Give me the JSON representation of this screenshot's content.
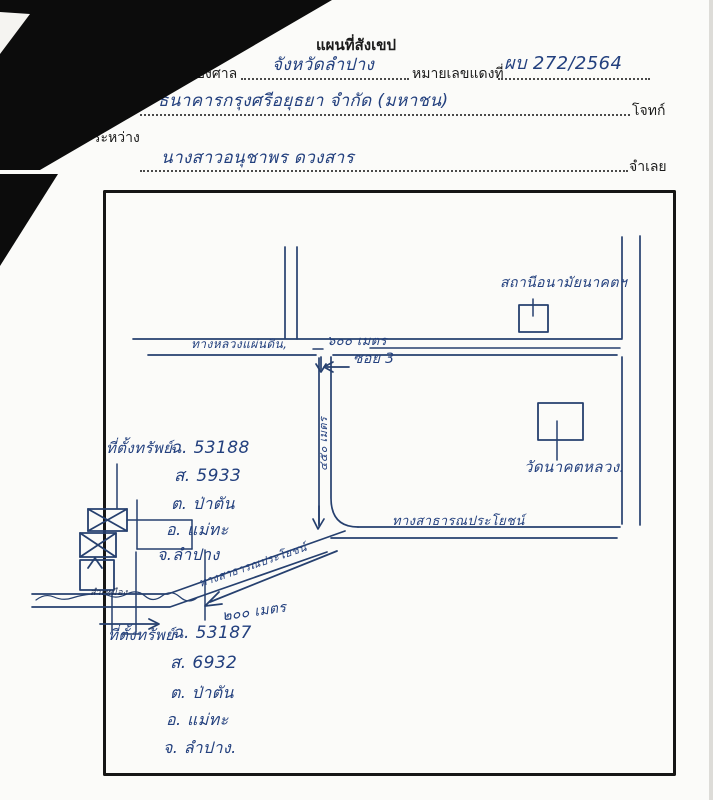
{
  "header": {
    "title": "แผนที่สังเขป",
    "case_label": "คดี",
    "case_type_value": "แพ่ง",
    "court_label": "ของศาล",
    "court_name_value": "จังหวัดลำปาง",
    "red_case_label": "หมายเลขแดงที่",
    "red_case_value": "ผบ 272/2564",
    "plaintiff_name_value": "ธนาคารกรุงศรีอยุธยา จำกัด (มหาชน)",
    "plaintiff_label": "โจทก์",
    "between_label": "ระหว่าง",
    "defendant_name_value": "นางสาวอนุชาพร ดวงสาร",
    "defendant_label": "จำเลย"
  },
  "map": {
    "roads": {
      "highway": "ทางหลวงแผ่นดิน,",
      "soi": "ซอย 3",
      "public_road": "ทางสาธารณประโยชน์",
      "public_road_diagonal": "ทางสาธารณประโยชน์",
      "canal": "ลำเหมือง"
    },
    "distances": {
      "d600": "๖๐๐ เมตร",
      "d450": "๔๕๐ เมตร",
      "d200": "๒๐๐ เมตร"
    },
    "places": {
      "health_station": "สถานีอนามัยนาคตฯ",
      "temple": "วัดนาคตหลวง."
    },
    "property1": {
      "title": "ที่ตั้งทรัพย์",
      "lines": [
        "ฉ. 53188",
        "ส. 5933",
        "ต. ป่าตัน",
        "อ. แม่ทะ",
        "จ.ลำปาง"
      ]
    },
    "property2": {
      "title": "ที่ตั้งทรัพย์",
      "lines": [
        "ฉ. 53187",
        "ส. 6932",
        "ต. ป่าตัน",
        "อ. แม่ทะ",
        "จ. ลำปาง."
      ]
    }
  },
  "colors": {
    "ink_blue": "#26406f",
    "printed_black": "#1b1b1b",
    "border_black": "#161616",
    "paper": "#fbfbf9"
  }
}
